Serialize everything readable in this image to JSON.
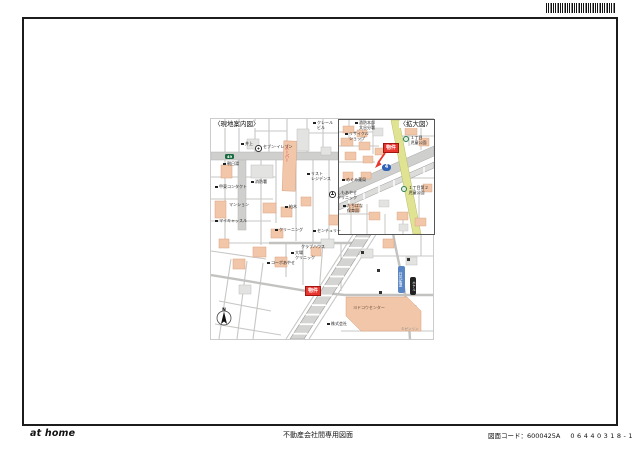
{
  "footer": {
    "logo": "at home",
    "document_type": "不動産会社間専用図面",
    "code": "図面コード：6000425A",
    "code_number": "06440318-1"
  },
  "map": {
    "main": {
      "title": "〈現地案内図〉",
      "north": "N",
      "credit": "©ゼンリン",
      "shield_49": "49",
      "route_name_vertical": "日光街道",
      "hotel_vertical": "ホテル",
      "store_vertical": "スーパー",
      "property_label": "物件",
      "big_building_label": "ヨドコウセンター",
      "labels": [
        "井上",
        "セブン-イレブン",
        "朝日湯",
        "消防署",
        "甲東コンタクト",
        "リスト\nレジデンス",
        "しもあやせ\nクリニック",
        "マンション",
        "柏木",
        "マイキャッスル",
        "クリーニング",
        "センチュリー",
        "クラブハウス",
        "大場\nクリニック",
        "コーポあやせ",
        "株式会社",
        "クレール\nビル"
      ]
    },
    "inset": {
      "title": "〈拡大図〉",
      "route_shield": "4",
      "property_label": "物件",
      "labels": [
        "消防本部\n大谷分署",
        "リサイクル\nショップ",
        "１丁目\n児童公園",
        "１丁目第２\n児童公園",
        "めぐみ薬局",
        "たちばな\n保育園"
      ]
    }
  }
}
